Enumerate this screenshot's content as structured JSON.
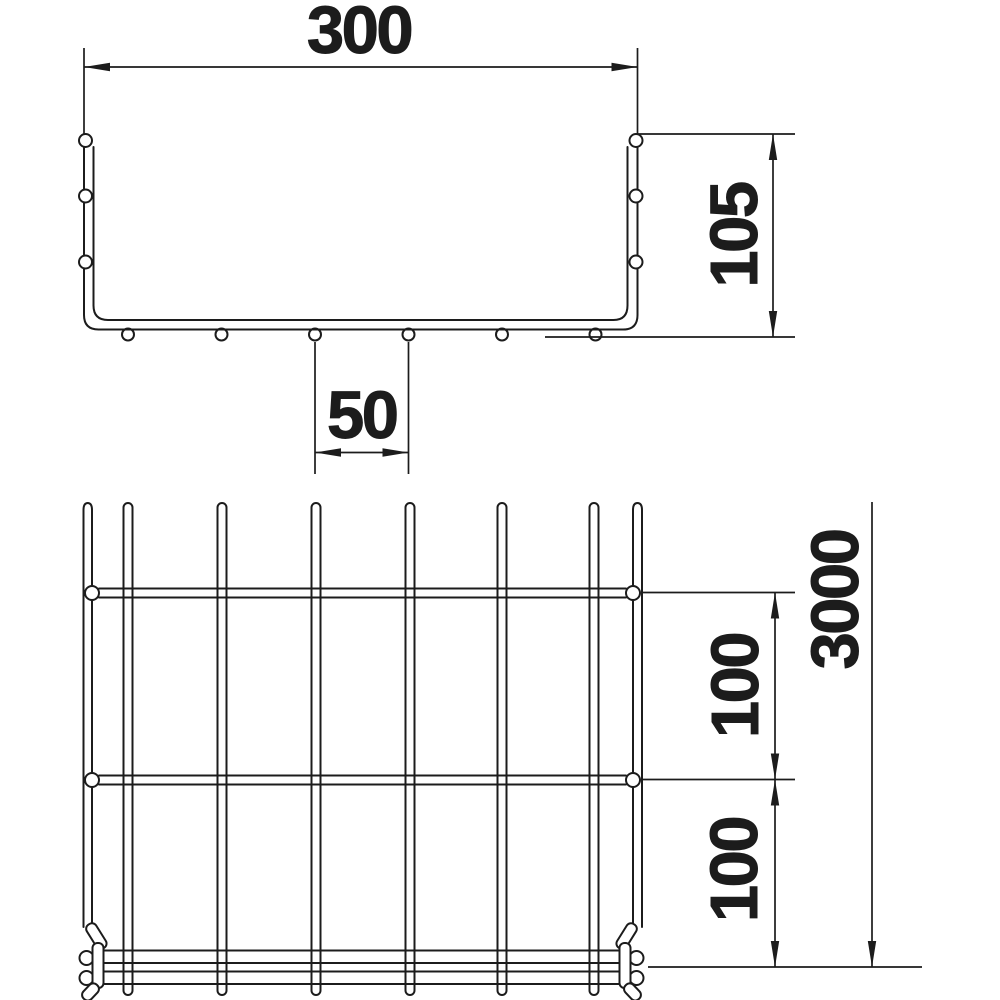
{
  "drawing": {
    "background_color": "#ffffff",
    "line_color": "#1c1c1c",
    "cross_section": {
      "dim_width": "300",
      "dim_height": "105",
      "dim_wire_spacing": "50"
    },
    "plan": {
      "dim_rung_pitch_top": "100",
      "dim_rung_pitch_bottom": "100",
      "dim_length": "3000"
    }
  }
}
